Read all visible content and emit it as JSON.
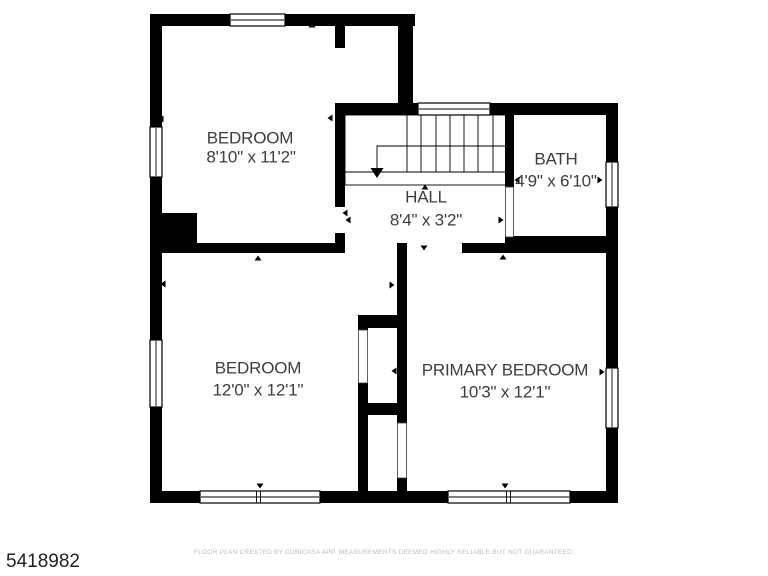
{
  "listing_id": "5418982",
  "disclaimer": "FLOOR PLAN CREATED BY CUBICASA APP. MEASUREMENTS DEEMED HIGHLY RELIABLE BUT NOT GUARANTEED.",
  "rooms": [
    {
      "name": "BEDROOM",
      "dimensions": "8'10\" x 11'2\""
    },
    {
      "name": "BATH",
      "dimensions": "4'9\" x 6'10\""
    },
    {
      "name": "HALL",
      "dimensions": "8'4\" x 3'2\""
    },
    {
      "name": "BEDROOM",
      "dimensions": "12'0\" x 12'1\""
    },
    {
      "name": "PRIMARY BEDROOM",
      "dimensions": "10'3\" x 12'1\""
    }
  ],
  "colors": {
    "wall": "#000000",
    "room_label": "#3d3d3d",
    "listing_id_text": "#1f1f1f",
    "disclaimer_text": "#bcbcbc",
    "background": "#ffffff"
  }
}
